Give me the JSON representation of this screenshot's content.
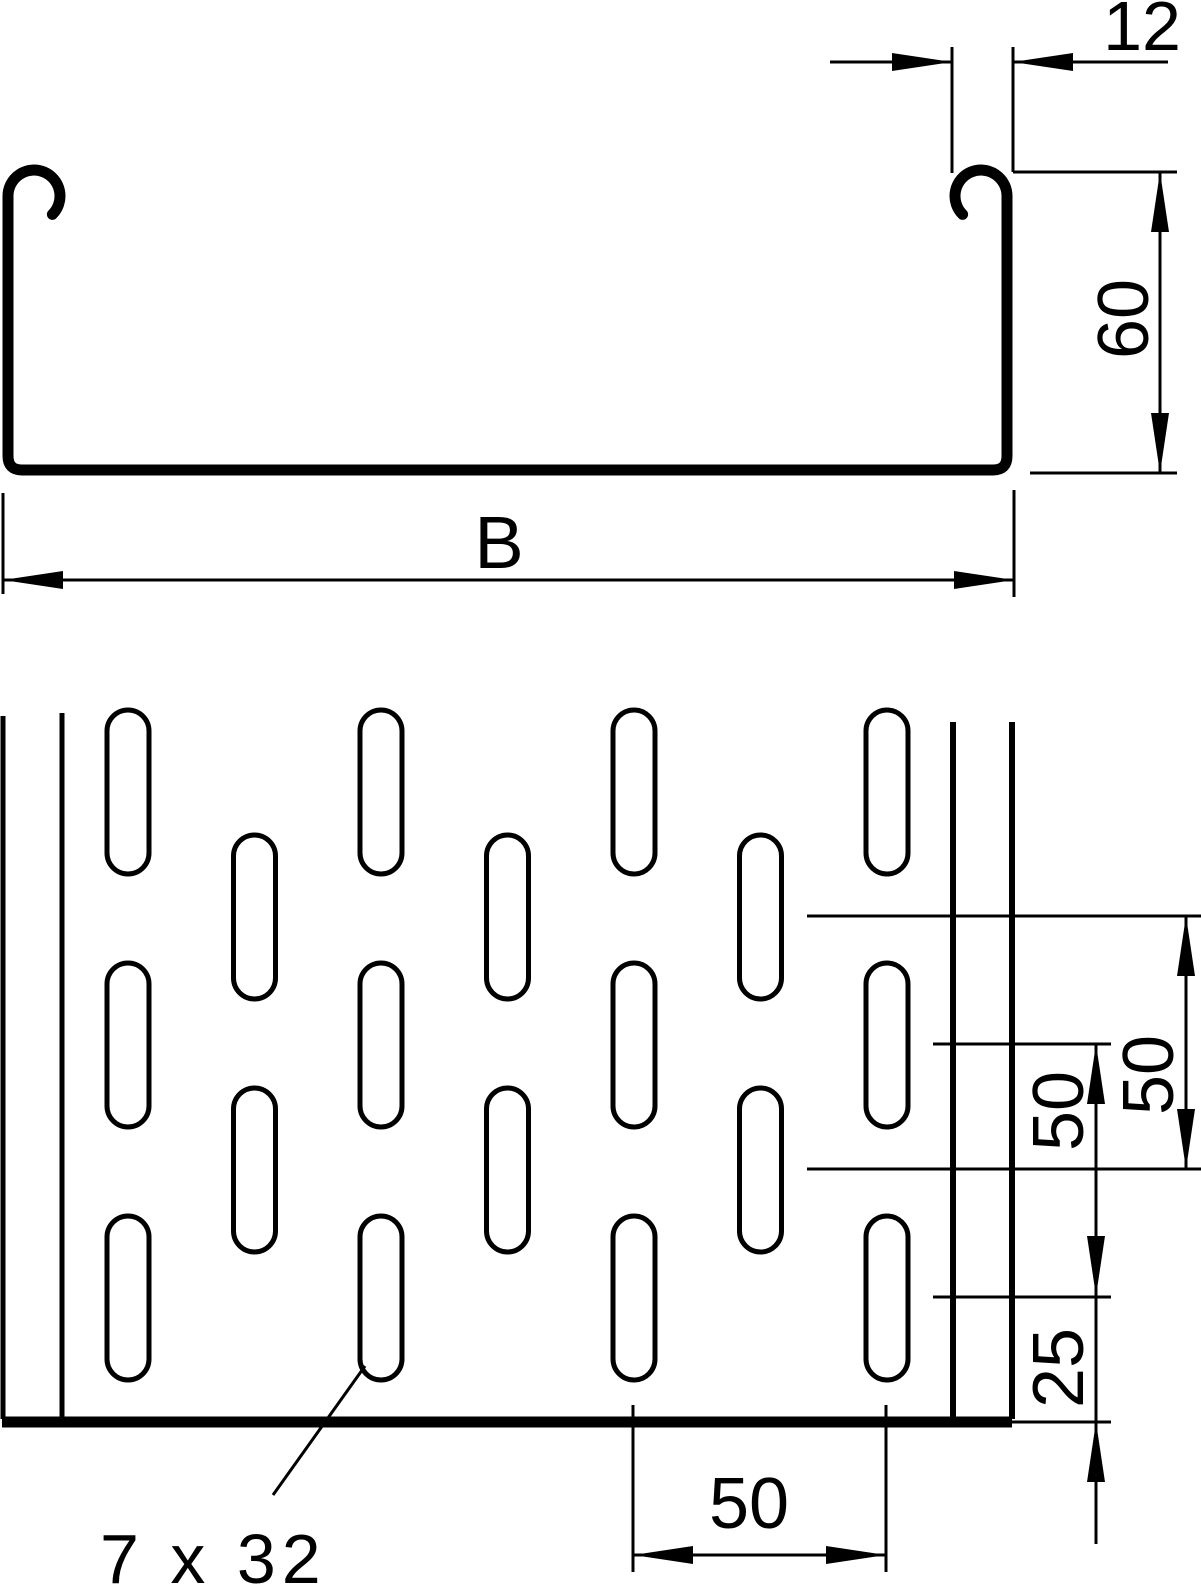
{
  "drawing": {
    "title": "Perforated cable tray technical drawing",
    "colors": {
      "line": "#000000",
      "background": "#ffffff"
    },
    "cross_section": {
      "flange_width_label": "12",
      "height_label": "60",
      "width_label": "B"
    },
    "plan_view": {
      "row_pitch_label_outer": "50",
      "row_pitch_label_inner": "50",
      "bottom_edge_offset_label": "25",
      "column_pitch_label": "50",
      "slot_size_label": "7 x 32"
    }
  }
}
